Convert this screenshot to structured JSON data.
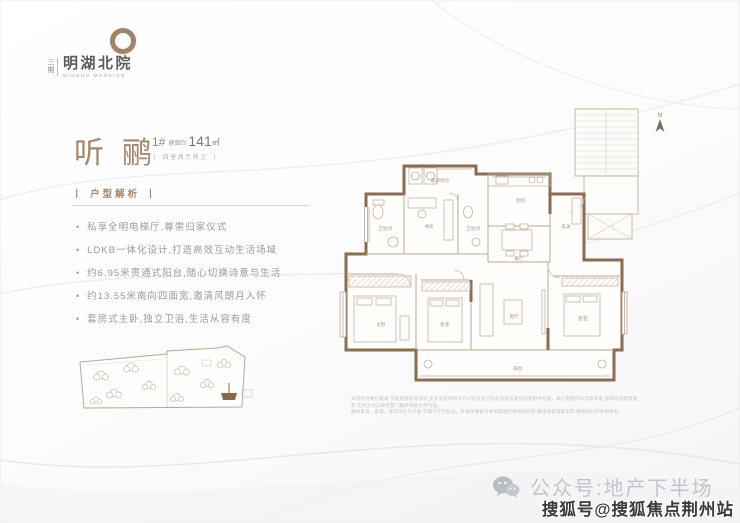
{
  "brand": {
    "phase_vertical": "三期",
    "name": "明湖北院",
    "name_latin": "MINGHU MANSION"
  },
  "unit": {
    "title": "听鹂",
    "number": "1#",
    "area_prefix": "建面约",
    "area_value": "141",
    "area_unit": "㎡",
    "layout_tag": "丨 四室两厅两卫 丨"
  },
  "analysis": {
    "heading": "丨 户型解析 丨",
    "features": [
      "私享全明电梯厅,尊崇归家仪式",
      "LDKB一体化设计,打造高效互动生活场域",
      "约6.95米贯通式阳台,随心切换诗意与生活",
      "约13.55米南向四面宽,邀清风朗月入怀",
      "套房式主卧,独立卫浴,生活从容有度"
    ]
  },
  "floorplan": {
    "compass_label": "N",
    "rooms": [
      {
        "label": "家政阳台"
      },
      {
        "label": "书房"
      },
      {
        "label": "卫生间"
      },
      {
        "label": "卫生间"
      },
      {
        "label": "厨房"
      },
      {
        "label": "餐厅"
      },
      {
        "label": "玄关"
      },
      {
        "label": "客厅"
      },
      {
        "label": "主卧"
      },
      {
        "label": "卧室"
      },
      {
        "label": "卧室"
      },
      {
        "label": "阳台"
      }
    ],
    "disclaimer_line1": "本资料为要约邀请,不构成要约或承诺,买卖双方权利义务以双方签订的商品房买卖合同及附件为准。本户型图仅作示意参考,面积均为建筑面积,实际交付以政府部门最终审批文件为准。",
    "disclaimer_line2": "图中家具、家电、装饰等仅为示意,不属于交付标准。开发商保留对本资料进行修改的权利,敬请留意最新资料,解释权归开发商所有。"
  },
  "footer": {
    "wechat_label": "公众号:地产下半场",
    "watermark": "搜狐号@搜狐焦点荆州站"
  },
  "colors": {
    "accent_brown": "#a5876c",
    "wall_brown": "#8a6c51",
    "light_wall": "#cbbfb0",
    "text_gray": "#9b9b9b",
    "footer_gray": "#c1c4ca",
    "watermark_dark": "#3a3a3e"
  }
}
